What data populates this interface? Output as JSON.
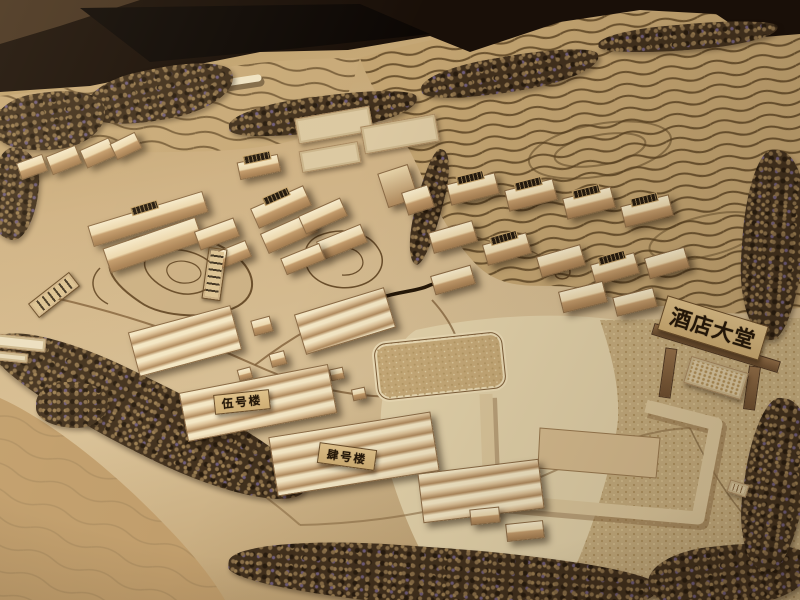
{
  "scene": {
    "signs": {
      "hotel_lobby": "酒店大堂",
      "building_no5": "伍号楼",
      "building_no4": "肆号楼"
    },
    "palette": {
      "backdrop_dark": "#190f08",
      "terrain_tan": "#c8ac80",
      "terrain_light": "#e3d2aa",
      "contour_brown": "#6a4e2b",
      "terrace_line": "#57401f",
      "wood_light": "#f4e7c5",
      "wood_shadow": "#a37c50",
      "sign_background": "#cfae74",
      "sign_text": "#241708",
      "foliage": "#41301d"
    }
  }
}
